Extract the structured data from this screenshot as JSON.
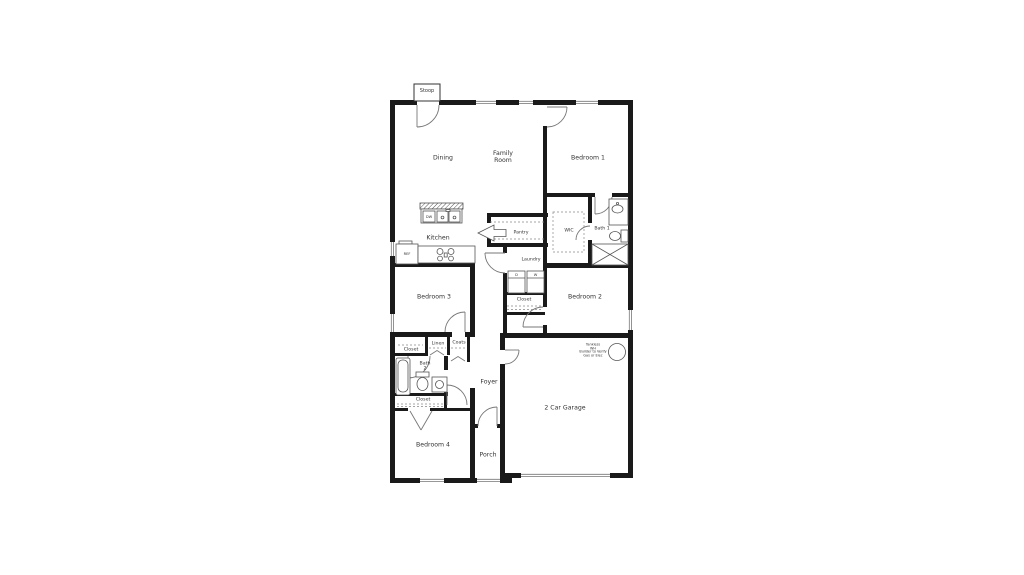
{
  "title": "Single-story house floor plan",
  "rooms": {
    "stoop": "Stoop",
    "dining": "Dining",
    "family_room": "Family\nRoom",
    "bedroom1": "Bedroom 1",
    "kitchen": "Kitchen",
    "pantry": "Pantry",
    "wic": "WIC",
    "bath1": "Bath 1",
    "laundry": "Laundry",
    "hall_closet": "Closet",
    "bedroom2": "Bedroom 2",
    "bedroom3": "Bedroom 3",
    "upper_closet": "Closet",
    "linen": "Linen",
    "coats": "Coats",
    "bath2": "Bath\n2",
    "lower_closet": "Closet",
    "foyer": "Foyer",
    "bedroom4": "Bedroom 4",
    "porch": "Porch",
    "garage": "2 Car Garage"
  },
  "appliances": {
    "dishwasher": "DW",
    "refrigerator": "REF",
    "dryer": "D",
    "washer": "W"
  },
  "notes": {
    "water_heater": "Tankless\nWH\nBuilder to Verify\nGas or Elec"
  },
  "colors": {
    "wall": "#1a1a1a",
    "thin_line": "#777777",
    "fixture_line": "#555555",
    "text": "#333333",
    "background": "#ffffff"
  }
}
